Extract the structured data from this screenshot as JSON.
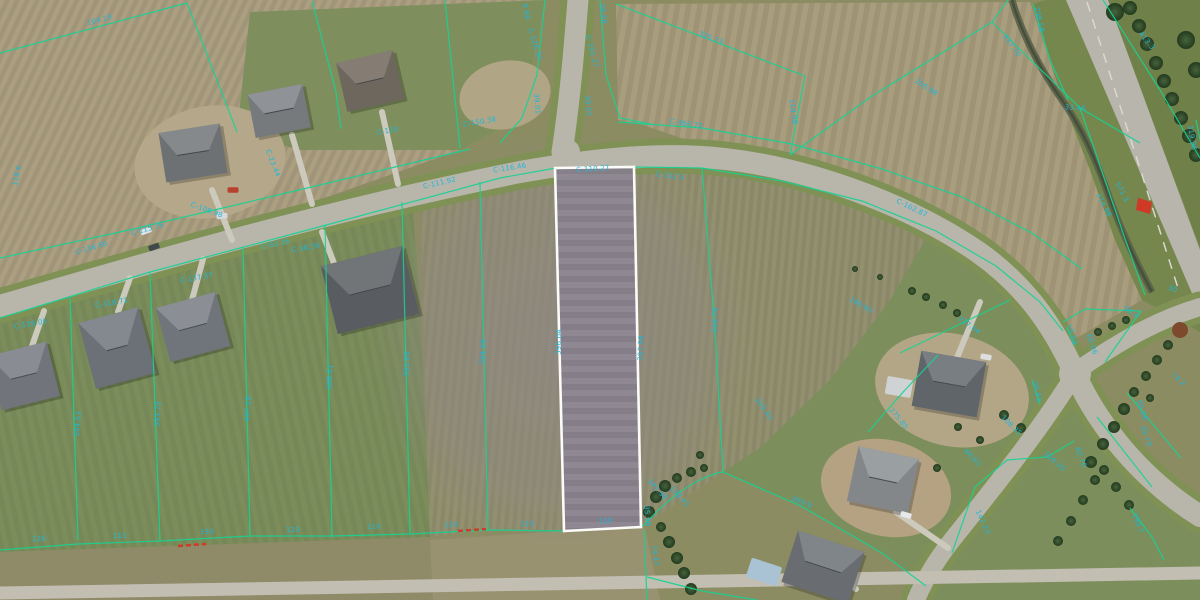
{
  "map": {
    "type": "aerial-parcel-gis-view",
    "colors": {
      "parcel_line": "#17d193",
      "dimension_text": "#1fb6d8",
      "selected_outline": "#fbfbf8",
      "road": "#b8b6ab",
      "road_verge": "#7f9154",
      "driveway": "#ccc9bd",
      "annotation_red": "#cf3a26",
      "highway": "#b7b5ac",
      "creek": "#59624a"
    },
    "selected_parcel": {
      "points": "555,168 634,167 641,527 564,531",
      "frontage_label": "C-110.27",
      "depth_labels": [
        "396.04",
        "397.98"
      ],
      "width_label": "110"
    },
    "fields": [
      {
        "d": "M0,0H1200V600H0Z",
        "f": "#8b8c62",
        "n": "base-terrain"
      },
      {
        "d": "M0,0 L545,0 L522,118 L460,150 L330,196 L150,252 L0,300 Z",
        "f": "url(#pTanTL)",
        "n": "plowed-field-northwest"
      },
      {
        "d": "M250,12 L545,0 L522,118 L460,150 L300,150 L237,133 Z",
        "f": "#7e8f5d",
        "n": "lawn-lots-north"
      },
      {
        "d": "M616,4 L1030,2 L1062,98 L1090,170 L1115,240 L1142,300 L1073,340 L1000,268 L930,226 L840,190 L740,158 L640,124 L618,120 Z",
        "f": "url(#pTanTR)",
        "n": "plowed-field-northeast"
      },
      {
        "d": "M420,196 L560,168 L705,168 L785,182 L862,202 L930,232 L890,300 L830,380 L760,448 L723,472 L645,524 L564,531 L488,530 L430,537 Z",
        "f": "url(#pRows)",
        "n": "plowed-field-center"
      },
      {
        "d": "M0,318 L332,224 L412,202 L420,300 L430,537 L0,552 Z",
        "f": "url(#pLawn)",
        "n": "lawn-lots-southwest"
      },
      {
        "d": "M0,552 L430,537 L564,531 L645,527 L660,600 L0,600 Z",
        "f": "#8f8a68",
        "n": "field-south"
      },
      {
        "d": "M430,540 L564,531 L645,527 L660,600 L433,600 Z",
        "f": "#9a9372",
        "o": 0.85,
        "n": "field-south-light"
      },
      {
        "d": "M930,232 L890,300 L830,380 L760,448 L723,472 L801,506 L882,553 L926,586 L916,600 L1200,600 L1200,516 L1075,374 L1040,302 L996,266 Z",
        "f": "#7c8e5b",
        "n": "lawn-southeast"
      },
      {
        "d": "M1046,0 L1124,0 L1200,266 L1200,332 L1142,300 L1115,240 L1090,170 L1062,98 L1033,4 Z",
        "f": "#75874d",
        "n": "highway-verge"
      },
      {
        "d": "M1108,0 L1200,0 L1200,248 Z",
        "f": "#6f8149",
        "n": "tree-strip-east"
      },
      {
        "ell": [
          560,
          340,
          190,
          210
        ],
        "f": "url(#gGray)",
        "n": "gray-soil-zone"
      }
    ],
    "creek": {
      "d": "M1012,0 C1022,35 1042,72 1062,100 C1082,128 1096,160 1108,194 C1120,228 1136,262 1152,292"
    },
    "highway": {
      "poly": "1066,0 1108,0 1200,250 1200,312",
      "center": "M1087,2 L1178,288"
    },
    "roads": [
      {
        "d": "M0,306 C150,262 330,210 520,172 C600,158 665,152 725,159 C805,168 905,202 978,252 C1022,283 1052,322 1075,374 C1098,425 1140,478 1200,516",
        "w": 22,
        "verge": true,
        "n": "main-subdivision-road"
      },
      {
        "d": "M578,0 C574,50 570,100 562,152",
        "w": 21,
        "verge": true,
        "n": "north-road"
      },
      {
        "d": "M1075,372 C1110,348 1150,322 1200,307",
        "w": 18,
        "verge": true,
        "n": "east-branch-road"
      },
      {
        "d": "M1075,374 C1040,430 1000,480 952,540 C938,558 925,578 916,600",
        "w": 18,
        "verge": true,
        "n": "south-branch-road"
      },
      {
        "d": "M0,593 C300,587 700,581 1200,573",
        "w": 13,
        "c": "#c2bfb2",
        "n": "south-edge-road"
      }
    ],
    "road_patches": [
      [
        567,
        152,
        13
      ],
      [
        1075,
        374,
        16
      ]
    ],
    "dirt_patches": [
      {
        "e": [
          210,
          162,
          76,
          56,
          -10
        ],
        "c": "#b5a88a"
      },
      {
        "e": [
          952,
          390,
          78,
          56,
          14
        ],
        "c": "#b3a686"
      },
      {
        "e": [
          886,
          488,
          66,
          48,
          14
        ],
        "c": "#b4a283"
      },
      {
        "e": [
          505,
          95,
          46,
          34,
          -12
        ],
        "c": "#b0a585"
      }
    ],
    "driveways": [
      "M212,190 L232,240",
      "M292,135 L312,204",
      "M382,112 L398,184",
      "M345,292 L322,232",
      "M118,312 L130,278",
      "M192,300 L203,259",
      "M32,346 L44,311",
      "M956,360 L980,302",
      "M896,512 L948,548",
      "M826,566 L856,589"
    ],
    "houses": [
      {
        "x": 162,
        "y": 128,
        "w": 62,
        "h": 50,
        "r": -9,
        "c1": "#6e7173",
        "c2": "#8a8d8f"
      },
      {
        "x": 251,
        "y": 89,
        "w": 56,
        "h": 44,
        "r": -11,
        "c1": "#777a7d",
        "c2": "#93969a"
      },
      {
        "x": 341,
        "y": 56,
        "w": 58,
        "h": 50,
        "r": -13,
        "c1": "#6d675e",
        "c2": "#8a8177"
      },
      {
        "x": -6,
        "y": 348,
        "w": 60,
        "h": 56,
        "r": -14,
        "c1": "#71757b",
        "c2": "#8d9197"
      },
      {
        "x": 86,
        "y": 314,
        "w": 62,
        "h": 68,
        "r": -15,
        "c1": "#6c7077",
        "c2": "#888c93"
      },
      {
        "x": 162,
        "y": 299,
        "w": 62,
        "h": 56,
        "r": -15,
        "c1": "#70747b",
        "c2": "#8f939a"
      },
      {
        "x": 328,
        "y": 255,
        "w": 84,
        "h": 70,
        "r": -14,
        "c1": "#595d61",
        "c2": "#75797d"
      },
      {
        "x": 916,
        "y": 356,
        "w": 66,
        "h": 56,
        "r": 10,
        "c1": "#606569",
        "c2": "#7e8387"
      },
      {
        "x": 852,
        "y": 452,
        "w": 62,
        "h": 56,
        "r": 12,
        "c1": "#83878a",
        "c2": "#9fa3a6"
      },
      {
        "x": 788,
        "y": 540,
        "w": 70,
        "h": 54,
        "r": 18,
        "c1": "#696d71",
        "c2": "#858a8e"
      }
    ],
    "extras": [
      {
        "x": 748,
        "y": 562,
        "w": 32,
        "h": 20,
        "r": 18,
        "c": "#a9c2d4",
        "n": "swimming-pool"
      },
      {
        "x": 886,
        "y": 378,
        "w": 26,
        "h": 18,
        "r": 10,
        "c": "#cfd3d4",
        "n": "shed-roof"
      }
    ],
    "cars": [
      [
        146,
        231,
        -20,
        "#dde2e4"
      ],
      [
        154,
        247,
        -20,
        "#42474c"
      ],
      [
        222,
        216,
        -5,
        "#d7d9da"
      ],
      [
        233,
        190,
        0,
        "#b8402f"
      ],
      [
        906,
        515,
        15,
        "#e6e8e9"
      ],
      [
        986,
        357,
        10,
        "#dcdedf"
      ]
    ],
    "trees": [
      [
        1091,
        462,
        6
      ],
      [
        1103,
        444,
        6
      ],
      [
        1114,
        427,
        6
      ],
      [
        1124,
        409,
        6
      ],
      [
        1134,
        392,
        5
      ],
      [
        1146,
        376,
        5
      ],
      [
        1157,
        360,
        5
      ],
      [
        1168,
        345,
        5
      ],
      [
        1150,
        398,
        4
      ],
      [
        1095,
        480,
        5
      ],
      [
        1083,
        500,
        5
      ],
      [
        1071,
        521,
        5
      ],
      [
        1058,
        541,
        5
      ],
      [
        1180,
        330,
        8,
        "#7e4a2e"
      ],
      [
        649,
        512,
        6
      ],
      [
        656,
        497,
        6
      ],
      [
        665,
        486,
        6
      ],
      [
        677,
        478,
        5
      ],
      [
        691,
        472,
        5
      ],
      [
        704,
        468,
        4
      ],
      [
        661,
        527,
        5
      ],
      [
        669,
        542,
        6
      ],
      [
        677,
        558,
        6
      ],
      [
        684,
        573,
        6
      ],
      [
        691,
        589,
        6
      ],
      [
        912,
        291,
        4
      ],
      [
        926,
        297,
        4
      ],
      [
        943,
        305,
        4
      ],
      [
        957,
        313,
        4
      ],
      [
        855,
        269,
        3
      ],
      [
        880,
        277,
        3
      ],
      [
        1130,
        8,
        7
      ],
      [
        1139,
        26,
        7
      ],
      [
        1147,
        44,
        7
      ],
      [
        1156,
        63,
        7
      ],
      [
        1164,
        81,
        7
      ],
      [
        1172,
        99,
        7
      ],
      [
        1181,
        118,
        7
      ],
      [
        1189,
        136,
        7
      ],
      [
        1196,
        155,
        7
      ],
      [
        1186,
        40,
        9
      ],
      [
        1196,
        70,
        8
      ],
      [
        1115,
        12,
        9
      ],
      [
        1004,
        415,
        5
      ],
      [
        1021,
        428,
        5
      ],
      [
        937,
        468,
        4
      ],
      [
        1104,
        470,
        5
      ],
      [
        1116,
        487,
        5
      ],
      [
        1129,
        505,
        5
      ],
      [
        980,
        440,
        4
      ],
      [
        958,
        427,
        4
      ],
      [
        1098,
        332,
        4
      ],
      [
        1112,
        326,
        4
      ],
      [
        1126,
        320,
        4
      ],
      [
        700,
        455,
        4
      ]
    ],
    "parcel_lines": [
      "M0,318 L150,272 L330,224 L500,178 L556,168",
      "M634,167 L702,168 L782,181 L862,201 L936,231 L996,266 L1040,302 L1063,331",
      "M0,258 L120,232 L240,204 L362,175 L470,149",
      "M618,122 L702,128 L792,144 L882,169 L962,197 L1032,233 L1082,269",
      "M187,3 L0,53",
      "M187,3 L237,132",
      "M312,1 L336,92 L341,129",
      "M445,0 L460,148",
      "M545,0 L537,75 L522,118 L500,143",
      "M600,0 L606,75 L620,118 L650,124",
      "M616,4 L805,76",
      "M805,76 L790,155",
      "M790,155 L872,96 L992,22",
      "M992,22 L1008,0",
      "M992,22 L1080,108 L1140,143",
      "M1080,108 L1098,160 L1122,230 L1145,295",
      "M1103,0 L1160,90 L1200,158",
      "M1033,4 L1050,60 L1068,100",
      "M70,296 L78,540",
      "M150,272 L160,541",
      "M243,247 L250,535",
      "M325,225 L332,536",
      "M402,202 L410,534",
      "M480,182 L488,530",
      "M702,168 L715,330 L723,472",
      "M0,550 L78,544 L160,541 L250,536 L332,536 L410,534 L488,530 L564,531",
      "M641,527 L645,524 Q672,494 700,480 Q714,473 723,472",
      "M723,472 L801,506 L882,553 L926,586",
      "M644,530 L647,600",
      "M647,577 L702,591 L757,600",
      "M900,353 L1010,300",
      "M1063,322 L1085,309 L1141,311 L1105,362",
      "M1127,393 L1181,458",
      "M1097,417 L1152,487",
      "M952,553 L975,487 L1007,460 L1047,457 L1074,441",
      "M1130,508 L1152,537 L1164,560",
      "M905,390 L938,355",
      "M868,432 L905,390",
      "M1032,380 L1040,404",
      "M1067,328 L1075,346",
      "M1196,120 L1200,140"
    ],
    "red_annotations": {
      "dashes": [
        "M178,546 L206,544",
        "M458,531 L486,529"
      ],
      "patch": "1138,198 1152,202 1150,214 1136,210"
    },
    "labels": [
      {
        "t": "104.19",
        "x": 100,
        "y": 22,
        "r": -15
      },
      {
        "t": "118.6",
        "x": 19,
        "y": 176,
        "r": -78
      },
      {
        "t": "C-23.44",
        "x": 271,
        "y": 164,
        "r": 68
      },
      {
        "t": "C-106.98",
        "x": 206,
        "y": 212,
        "r": 20
      },
      {
        "t": "C-136.60",
        "x": 92,
        "y": 250,
        "r": -16
      },
      {
        "t": "C-115.76",
        "x": 148,
        "y": 231,
        "r": -15
      },
      {
        "t": "C-92.16",
        "x": 276,
        "y": 246,
        "r": -12
      },
      {
        "t": "C-38.59",
        "x": 306,
        "y": 250,
        "r": -10
      },
      {
        "t": "C-111.92",
        "x": 440,
        "y": 185,
        "r": -13
      },
      {
        "t": "C-116.46",
        "x": 510,
        "y": 170,
        "r": -9
      },
      {
        "t": "C-150.38",
        "x": 480,
        "y": 124,
        "r": -10
      },
      {
        "t": "C-120",
        "x": 388,
        "y": 133,
        "r": -10
      },
      {
        "t": "C-110.27",
        "x": 593,
        "y": 171,
        "r": -4
      },
      {
        "t": "C-112.3",
        "x": 670,
        "y": 178,
        "r": 7
      },
      {
        "t": "C-366.72",
        "x": 686,
        "y": 126,
        "r": 8
      },
      {
        "t": "C-126.31",
        "x": 533,
        "y": 45,
        "r": 72
      },
      {
        "t": "9.86",
        "x": 524,
        "y": 12,
        "r": 80
      },
      {
        "t": "39.01",
        "x": 535,
        "y": 104,
        "r": 85
      },
      {
        "t": "39.66",
        "x": 601,
        "y": 14,
        "r": 82
      },
      {
        "t": "C-101.27",
        "x": 590,
        "y": 52,
        "r": 75
      },
      {
        "t": "39.01",
        "x": 586,
        "y": 106,
        "r": 85
      },
      {
        "t": "325.73",
        "x": 710,
        "y": 40,
        "r": 21
      },
      {
        "t": "119.98",
        "x": 791,
        "y": 112,
        "r": 82
      },
      {
        "t": "298.58",
        "x": 1037,
        "y": 20,
        "r": 78
      },
      {
        "t": "237.70",
        "x": 1010,
        "y": 47,
        "r": 55
      },
      {
        "t": "206.98",
        "x": 925,
        "y": 89,
        "r": 33
      },
      {
        "t": "33.46",
        "x": 1075,
        "y": 110,
        "r": 4
      },
      {
        "t": "413.3",
        "x": 1145,
        "y": 42,
        "r": 52
      },
      {
        "t": "571.3",
        "x": 1120,
        "y": 193,
        "r": 62
      },
      {
        "t": "314.98",
        "x": 1102,
        "y": 206,
        "r": 63
      },
      {
        "t": "319.98",
        "x": 1190,
        "y": 138,
        "r": 80
      },
      {
        "t": "C-162.87",
        "x": 911,
        "y": 210,
        "r": 26
      },
      {
        "t": "189.65",
        "x": 860,
        "y": 307,
        "r": 30
      },
      {
        "t": "257.04",
        "x": 968,
        "y": 327,
        "r": 35
      },
      {
        "t": "299.9",
        "x": 801,
        "y": 504,
        "r": 22
      },
      {
        "t": "229.43",
        "x": 762,
        "y": 410,
        "r": 55
      },
      {
        "t": "275.85",
        "x": 897,
        "y": 420,
        "r": 50
      },
      {
        "t": "C-126.05",
        "x": 31,
        "y": 326,
        "r": -10
      },
      {
        "t": "C-118.71",
        "x": 112,
        "y": 305,
        "r": -10
      },
      {
        "t": "C-137.37",
        "x": 197,
        "y": 280,
        "r": -10
      },
      {
        "t": "394.63",
        "x": 80,
        "y": 424,
        "r": -85
      },
      {
        "t": "393.70",
        "x": 160,
        "y": 414,
        "r": -86
      },
      {
        "t": "407.18",
        "x": 250,
        "y": 409,
        "r": -86
      },
      {
        "t": "388.61",
        "x": 332,
        "y": 377,
        "r": -87
      },
      {
        "t": "391.85",
        "x": 409,
        "y": 364,
        "r": -87
      },
      {
        "t": "394.10",
        "x": 485,
        "y": 352,
        "r": -87
      },
      {
        "t": "396.04",
        "x": 561,
        "y": 342,
        "r": -88
      },
      {
        "t": "397.98",
        "x": 643,
        "y": 348,
        "r": -88
      },
      {
        "t": "318.76",
        "x": 717,
        "y": 320,
        "r": -87
      },
      {
        "t": "126",
        "x": 39,
        "y": 541,
        "r": -3
      },
      {
        "t": "115",
        "x": 120,
        "y": 538,
        "r": -3
      },
      {
        "t": "130",
        "x": 207,
        "y": 534,
        "r": -2
      },
      {
        "t": "120",
        "x": 293,
        "y": 532,
        "r": -2
      },
      {
        "t": "110",
        "x": 374,
        "y": 529,
        "r": -2
      },
      {
        "t": "110",
        "x": 451,
        "y": 527,
        "r": -2
      },
      {
        "t": "110",
        "x": 527,
        "y": 526,
        "r": -2
      },
      {
        "t": "110",
        "x": 606,
        "y": 523,
        "r": -2
      },
      {
        "t": "74.47",
        "x": 653,
        "y": 556,
        "r": 80
      },
      {
        "t": "35.98",
        "x": 645,
        "y": 516,
        "r": 85
      },
      {
        "t": "141.98",
        "x": 656,
        "y": 491,
        "r": 48
      },
      {
        "t": "139.41",
        "x": 678,
        "y": 498,
        "r": 48
      },
      {
        "t": "108.25",
        "x": 1010,
        "y": 427,
        "r": 45
      },
      {
        "t": "66.61",
        "x": 971,
        "y": 459,
        "r": 45
      },
      {
        "t": "35.63",
        "x": 1035,
        "y": 392,
        "r": 78
      },
      {
        "t": "19.93",
        "x": 1070,
        "y": 335,
        "r": 72
      },
      {
        "t": "90.4",
        "x": 1130,
        "y": 314,
        "r": 35
      },
      {
        "t": "60.06",
        "x": 1090,
        "y": 345,
        "r": 72
      },
      {
        "t": "60.06",
        "x": 1140,
        "y": 411,
        "r": 72
      },
      {
        "t": "65.79",
        "x": 1144,
        "y": 437,
        "r": 72
      },
      {
        "t": "74.2",
        "x": 1177,
        "y": 381,
        "r": 40
      },
      {
        "t": "142.23",
        "x": 981,
        "y": 523,
        "r": 65
      },
      {
        "t": "106.25",
        "x": 1053,
        "y": 463,
        "r": 42
      },
      {
        "t": "62.76",
        "x": 1079,
        "y": 458,
        "r": 70
      },
      {
        "t": "199.7",
        "x": 1136,
        "y": 524,
        "r": 68
      },
      {
        "t": "30",
        "x": 1172,
        "y": 291,
        "r": 20
      }
    ]
  }
}
